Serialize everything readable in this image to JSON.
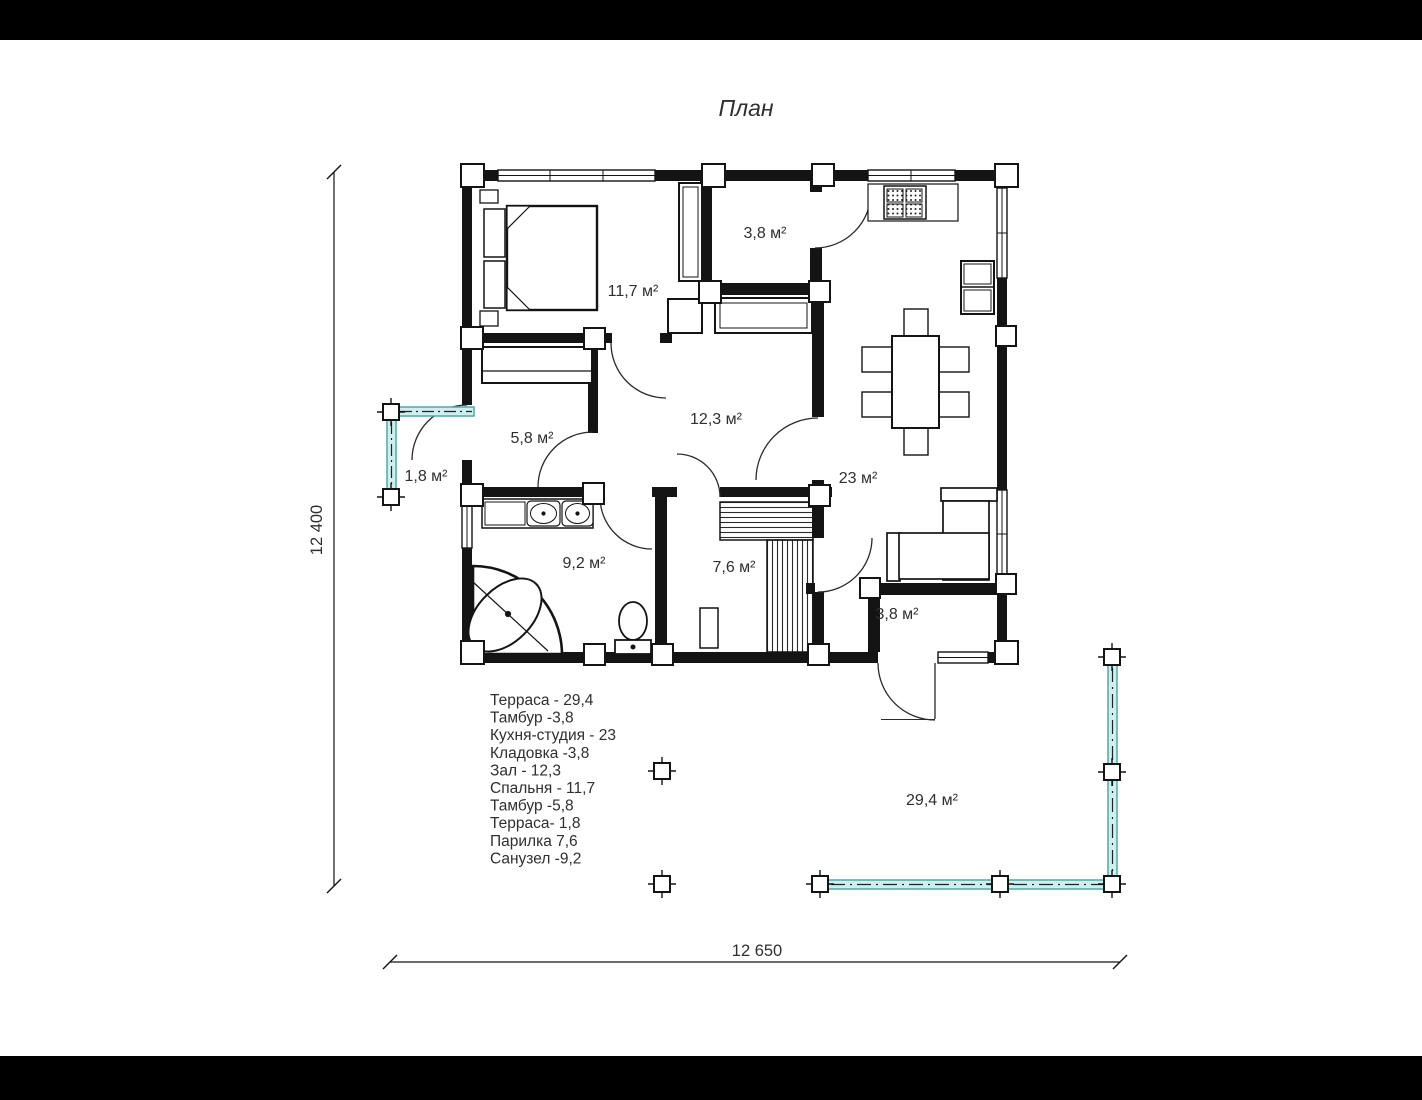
{
  "title": "План",
  "rooms": [
    {
      "name": "storage",
      "label": "3,8 м²"
    },
    {
      "name": "bedroom",
      "label": "11,7 м²"
    },
    {
      "name": "tambour-west",
      "label": "5,8 м²"
    },
    {
      "name": "terrace-small",
      "label": "1,8 м²"
    },
    {
      "name": "hall",
      "label": "12,3 м²"
    },
    {
      "name": "kitchen-studio",
      "label": "23 м²"
    },
    {
      "name": "bathroom",
      "label": "9,2 м²"
    },
    {
      "name": "sauna",
      "label": "7,6 м²"
    },
    {
      "name": "tambour-south",
      "label": "3,8 м²"
    },
    {
      "name": "terrace-large",
      "label": "29,4 м²"
    }
  ],
  "legend": {
    "lines": [
      "Терраса - 29,4",
      "Тамбур -3,8",
      "Кухня-студия - 23",
      "Кладовка -3,8",
      "Зал - 12,3",
      "Спальня - 11,7",
      "Тамбур -5,8",
      "Терраса- 1,8",
      "Парилка 7,6",
      "Санузел -9,2"
    ]
  },
  "dimensions": {
    "width_label": "12 650",
    "height_label": "12 400"
  },
  "colors": {
    "wall": "#141414",
    "text": "#2f2f2f",
    "railing_fill": "#cfeeed",
    "railing_stroke": "#4aacac",
    "letterbox": "#000000",
    "background": "#ffffff"
  }
}
